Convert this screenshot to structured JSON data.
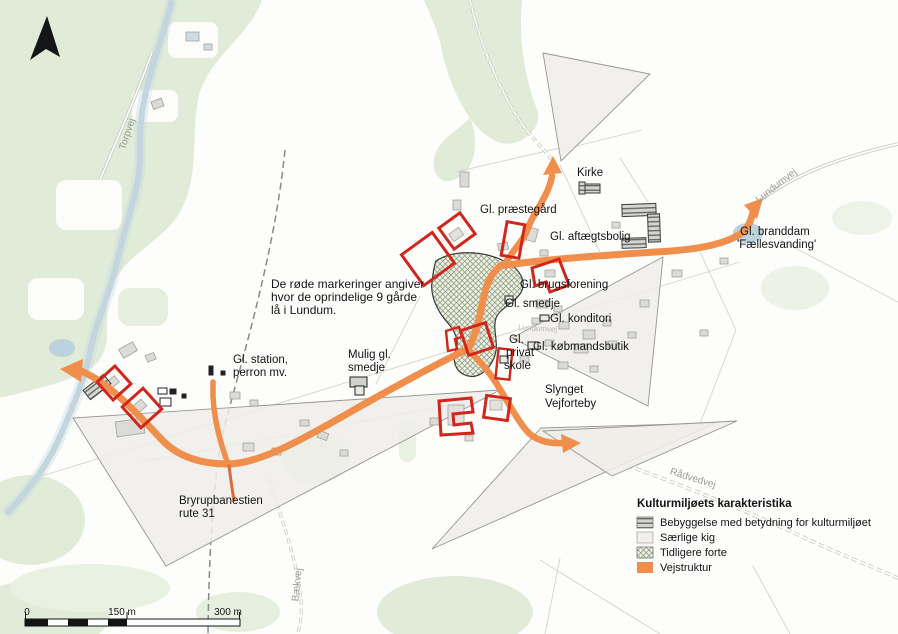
{
  "map": {
    "labels": {
      "kirke": "Kirke",
      "praestegaard": "Gl. præstegård",
      "aftaegtsbolig": "Gl. aftægtsbolig",
      "branddam_line1": "Gl. branddam",
      "branddam_line2": "'Fællesvanding'",
      "brugsforening": "Gl. brugsforening",
      "smedje": "Gl. smedje",
      "konditori": "Gl. konditori",
      "koebmandsbutik": "Gl. købmandsbutik",
      "privatskole_line1": "Gl.",
      "privatskole_line2": "privat",
      "privatskole_line3": "skole",
      "slynget_line1": "Slynget",
      "slynget_line2": "Vejforteby",
      "mulig_smedje_line1": "Mulig gl.",
      "mulig_smedje_line2": "smedje",
      "station_line1": "Gl. station,",
      "station_line2": "perron mv.",
      "bryrupbanestien_line1": "Bryrupbanestien",
      "bryrupbanestien_line2": "rute 31"
    },
    "note": {
      "line1": "De røde markeringer angiver",
      "line2": "hvor de oprindelige 9 gårde",
      "line3": "lå i Lundum."
    },
    "road_labels": {
      "torpvej": "Torpvej",
      "lundumvej": "Lundumvej",
      "raadvedvej": "Rådvedvej",
      "baekvej": "Bækvej",
      "lundumvej_center": "Lundumvej"
    }
  },
  "legend": {
    "title": "Kulturmiljøets karakteristika",
    "items": [
      {
        "label": "Bebyggelse med betydning for kulturmiljøet",
        "swatch": "hatched-gray"
      },
      {
        "label": "Særlige kig",
        "swatch": "light"
      },
      {
        "label": "Tidligere forte",
        "swatch": "crosshatch"
      },
      {
        "label": "Vejstruktur",
        "swatch": "orange"
      }
    ]
  },
  "scale_bar": {
    "start": "0",
    "mid": "150 m",
    "end": "300 m"
  },
  "colors": {
    "vejstruktur": "#EF8F4B",
    "farm_marker_red": "#D2251B",
    "vegetation_green": "#E1ECD8",
    "stream_blue": "#C3D6E0"
  }
}
